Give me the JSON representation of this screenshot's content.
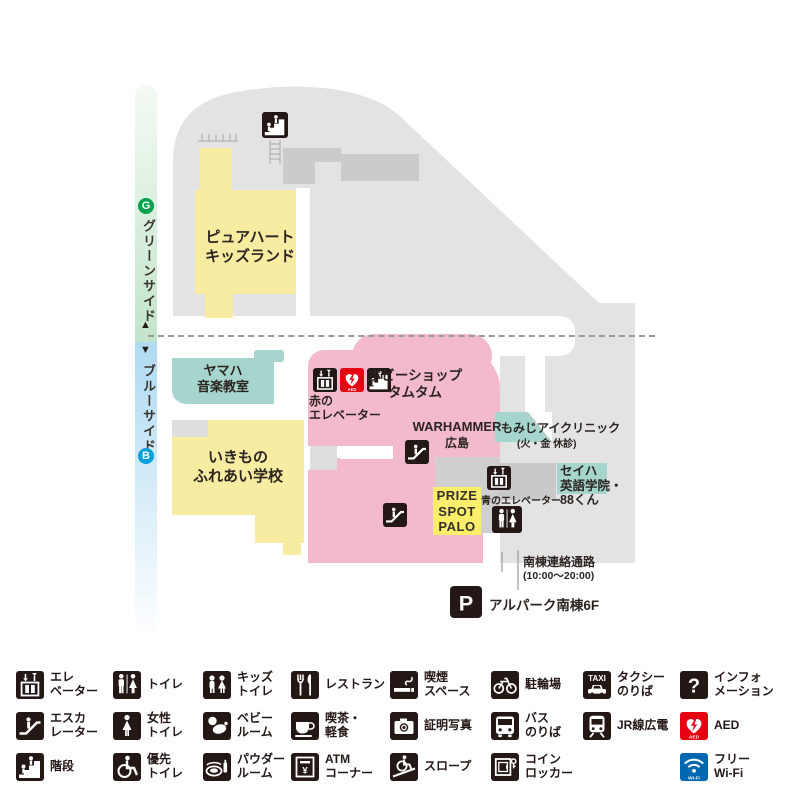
{
  "icon_text": {
    "aed": "AED",
    "wifi": "Wi-Fi",
    "taxi": "TAXI",
    "parking": "P",
    "question": "?",
    "yen": "¥"
  },
  "sidebar": {
    "green": {
      "badge": "G",
      "label": "グリーンサイド",
      "arrow": "▲"
    },
    "blue": {
      "badge": "B",
      "label": "ブルーサイド",
      "arrow": "▼"
    }
  },
  "map": {
    "pureheart": {
      "l1": "ピュアハート",
      "l2": "キッズランド"
    },
    "yamaha": {
      "l1": "ヤマハ",
      "l2": "音楽教室"
    },
    "ikimono": {
      "l1": "いきもの",
      "l2": "ふれあい学校"
    },
    "hobby": {
      "l1": "ホビーショップ",
      "l2": "タムタム"
    },
    "warhammer": {
      "l1": "WARHAMMER",
      "l2": "広島"
    },
    "momiji": {
      "l1": "もみじアイクリニック",
      "l2": "(火・金 休診)"
    },
    "seiha": {
      "l1": "セイハ",
      "l2": "英語学院・",
      "l3": "88くん"
    },
    "prize": {
      "l1": "PRIZE",
      "l2": "SPOT",
      "l3": "PALO"
    },
    "red_elevator": {
      "l1": "赤の",
      "l2": "エレベーター"
    },
    "blue_elevator": {
      "label": "青のエレベーター"
    },
    "corridor": {
      "l1": "南棟連絡通路",
      "l2": "(10:00～20:00)"
    },
    "parking_label": "アルパーク南棟6F"
  },
  "legend": {
    "items": [
      {
        "id": "elevator",
        "l1": "エレ",
        "l2": "ベーター"
      },
      {
        "id": "escalator",
        "l1": "エスカ",
        "l2": "レーター"
      },
      {
        "id": "stairs",
        "l1": "階段",
        "l2": ""
      },
      {
        "id": "toilet",
        "l1": "トイレ",
        "l2": ""
      },
      {
        "id": "women-toilet",
        "l1": "女性",
        "l2": "トイレ"
      },
      {
        "id": "priority-toilet",
        "l1": "優先",
        "l2": "トイレ"
      },
      {
        "id": "kids-toilet",
        "l1": "キッズ",
        "l2": "トイレ"
      },
      {
        "id": "baby-room",
        "l1": "ベビー",
        "l2": "ルーム"
      },
      {
        "id": "powder-room",
        "l1": "パウダー",
        "l2": "ルーム"
      },
      {
        "id": "restaurant",
        "l1": "レストラン",
        "l2": ""
      },
      {
        "id": "cafe",
        "l1": "喫茶・",
        "l2": "軽食"
      },
      {
        "id": "atm",
        "l1": "ATM",
        "l2": "コーナー"
      },
      {
        "id": "smoking",
        "l1": "喫煙",
        "l2": "スペース"
      },
      {
        "id": "photo",
        "l1": "証明写真",
        "l2": ""
      },
      {
        "id": "slope",
        "l1": "スロープ",
        "l2": ""
      },
      {
        "id": "bicycle",
        "l1": "駐輪場",
        "l2": ""
      },
      {
        "id": "bus",
        "l1": "バス",
        "l2": "のりば"
      },
      {
        "id": "locker",
        "l1": "コイン",
        "l2": "ロッカー"
      },
      {
        "id": "taxi",
        "l1": "タクシー",
        "l2": "のりば"
      },
      {
        "id": "train",
        "l1": "JR線広電",
        "l2": ""
      },
      {
        "id": "info",
        "l1": "インフォ",
        "l2": "メーション"
      },
      {
        "id": "aed",
        "l1": "AED",
        "l2": ""
      },
      {
        "id": "wifi",
        "l1": "フリー",
        "l2": "Wi-Fi"
      }
    ]
  }
}
